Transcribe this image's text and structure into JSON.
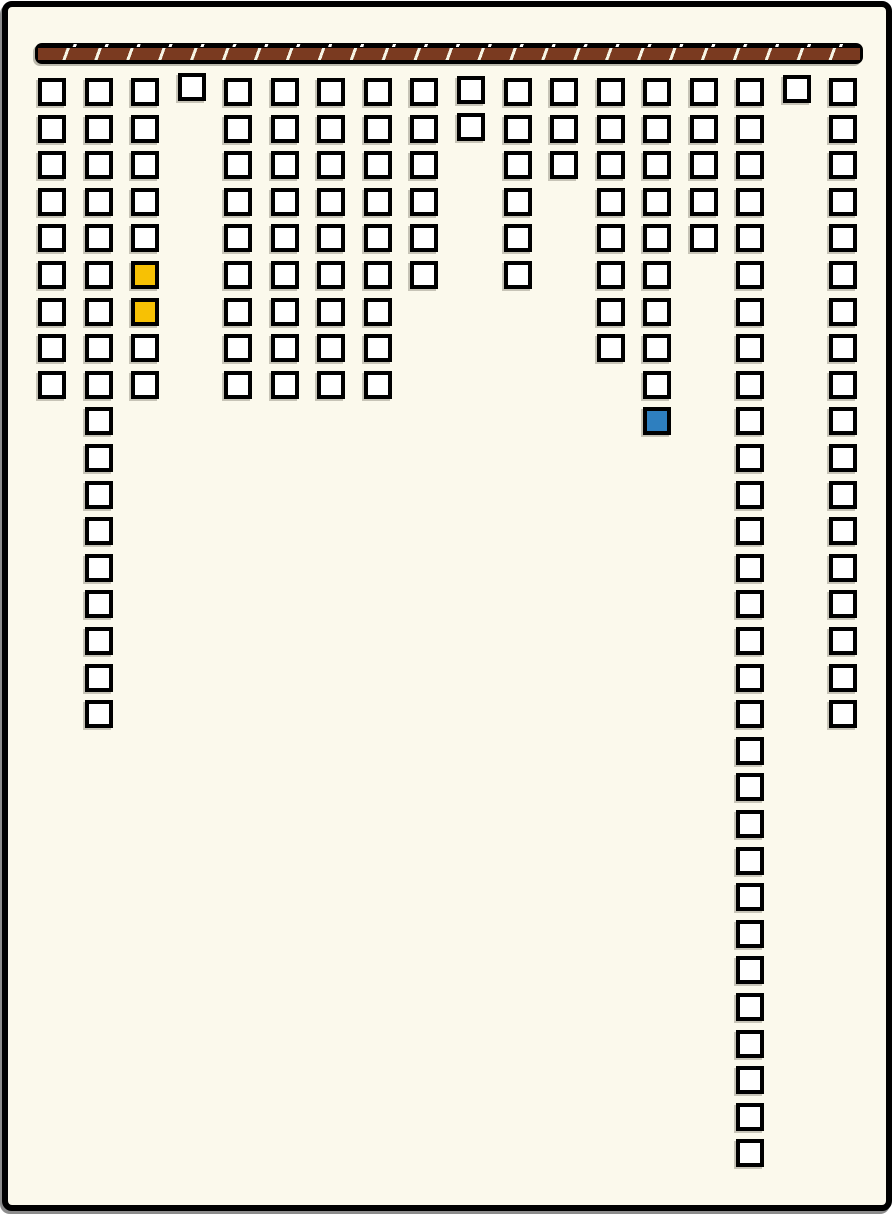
{
  "window": {
    "background_color": "#FBF9EC",
    "frame_color": "#000000"
  },
  "rail": {
    "fill_color": "#7A3A20",
    "stripe_color": "#F7F5E6",
    "outline_color": "#000000",
    "tick_color": "#FFFFFF",
    "segment_count": 25
  },
  "board": {
    "columns": 18,
    "max_rows": 30,
    "total_tiles": 162,
    "tile_default_color": "#FFFFFF",
    "tile_outline_color": "#000000",
    "column_counts": [
      9,
      18,
      9,
      1,
      9,
      9,
      9,
      9,
      6,
      2,
      6,
      3,
      8,
      10,
      5,
      30,
      1,
      18
    ],
    "column_y_offsets": [
      0,
      0,
      0,
      -5,
      0,
      0,
      0,
      0,
      0,
      -2,
      0,
      0,
      0,
      0,
      0,
      0,
      -3,
      0
    ],
    "colored_tiles": [
      {
        "column": 3,
        "row": 6,
        "color": "#F7C104",
        "name": "yellow-tile"
      },
      {
        "column": 3,
        "row": 7,
        "color": "#F7C104",
        "name": "yellow-tile"
      },
      {
        "column": 14,
        "row": 10,
        "color": "#2E7FBF",
        "name": "blue-tile"
      }
    ]
  }
}
